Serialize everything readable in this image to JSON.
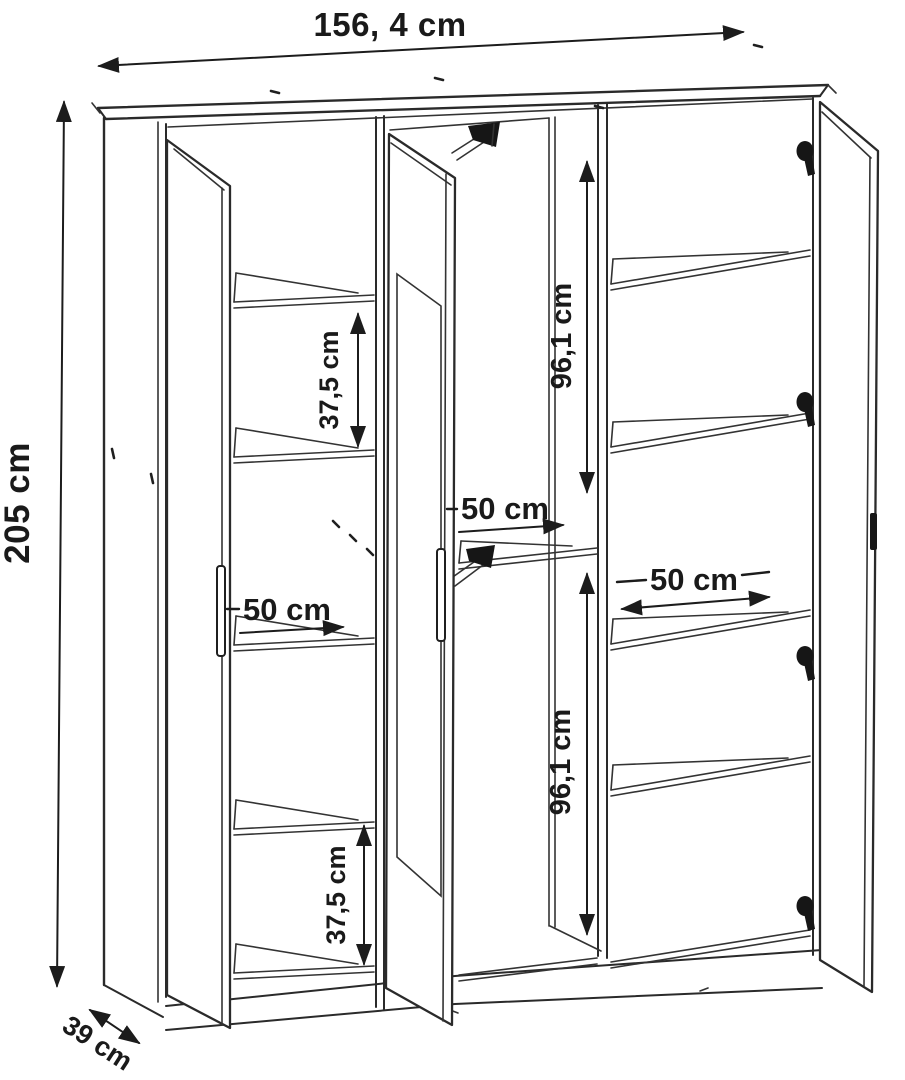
{
  "drawing": {
    "subject": "three-door wardrobe technical line drawing, front perspective view",
    "icons": {
      "hinge": "hinge-icon",
      "rail_bracket": "clothes-rail-bracket-icon",
      "door_handle": "door-handle-icon",
      "arrowhead": "dimension-arrowhead-icon"
    }
  },
  "dimensions": {
    "overall_width": {
      "label": "156, 4 cm"
    },
    "overall_height": {
      "label": "205 cm"
    },
    "overall_depth": {
      "label": "39 cm"
    },
    "left_column_upper_gap": {
      "label": "37,5 cm"
    },
    "left_column_lower_gap": {
      "label": "37,5 cm"
    },
    "left_column_width": {
      "label": "50 cm"
    },
    "middle_column_width": {
      "label": "50 cm"
    },
    "right_column_width": {
      "label": "50 cm"
    },
    "middle_upper_height": {
      "label": "96,1 cm"
    },
    "middle_lower_height": {
      "label": "96,1 cm"
    }
  },
  "colors": {
    "line": "#2a2a2a",
    "dimension": "#1c1c1c",
    "background": "#ffffff",
    "hardware": "#161616"
  }
}
